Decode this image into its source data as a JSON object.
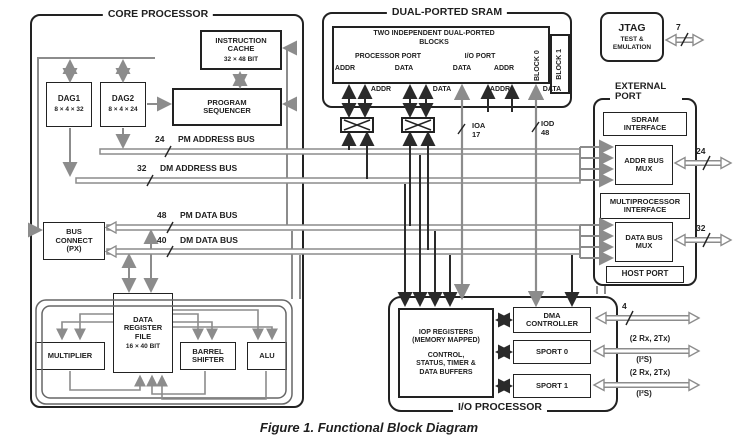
{
  "caption": "Figure 1. Functional Block Diagram",
  "core": {
    "title": "CORE PROCESSOR",
    "icache": {
      "name": "INSTRUCTION CACHE",
      "size": "32 × 48 BIT"
    },
    "dag1": {
      "name": "DAG1",
      "size": "8 × 4 × 32"
    },
    "dag2": {
      "name": "DAG2",
      "size": "8 × 4 × 24"
    },
    "sequencer": "PROGRAM SEQUENCER",
    "bus_connect": "BUS CONNECT (PX)",
    "regfile": {
      "name": "DATA REGISTER FILE",
      "size": "16 × 40 BIT"
    },
    "multiplier": "MULTIPLIER",
    "barrel_shifter": "BARREL SHIFTER",
    "alu": "ALU"
  },
  "buses": {
    "pm_addr": {
      "width": "24",
      "name": "PM ADDRESS BUS"
    },
    "dm_addr": {
      "width": "32",
      "name": "DM ADDRESS BUS"
    },
    "pm_data": {
      "width": "48",
      "name": "PM DATA BUS"
    },
    "dm_data": {
      "width": "40",
      "name": "DM DATA BUS"
    }
  },
  "sram": {
    "title": "DUAL-PORTED SRAM",
    "blocks_note": "TWO INDEPENDENT DUAL-PORTED BLOCKS",
    "processor_port": "PROCESSOR PORT",
    "io_port": "I/O PORT",
    "addr": "ADDR",
    "data": "DATA",
    "block0": "BLOCK 0",
    "block1": "BLOCK 1",
    "ioa": {
      "name": "IOA",
      "width": "17"
    },
    "iod": {
      "name": "IOD",
      "width": "48"
    }
  },
  "jtag": {
    "name": "JTAG",
    "sub": "TEST & EMULATION",
    "width": "7"
  },
  "external_port": {
    "title": "EXTERNAL PORT",
    "sdram": "SDRAM INTERFACE",
    "addr_mux": "ADDR BUS MUX",
    "multiprocessor": "MULTIPROCESSOR INTERFACE",
    "data_mux": "DATA BUS MUX",
    "host": "HOST PORT",
    "addr_width": "24",
    "data_width": "32"
  },
  "iop": {
    "title": "I/O PROCESSOR",
    "registers": "IOP REGISTERS (MEMORY MAPPED)",
    "registers_detail": "CONTROL, STATUS, TIMER & DATA BUFFERS",
    "dma": "DMA CONTROLLER",
    "sport0": "SPORT 0",
    "sport1": "SPORT 1",
    "dma_width": "4",
    "sport_channels": "(2 Rx, 2Tx)",
    "sport_mode": "(I²S)"
  },
  "colors": {
    "line": "#222222",
    "wire": "#8c8c8c"
  }
}
